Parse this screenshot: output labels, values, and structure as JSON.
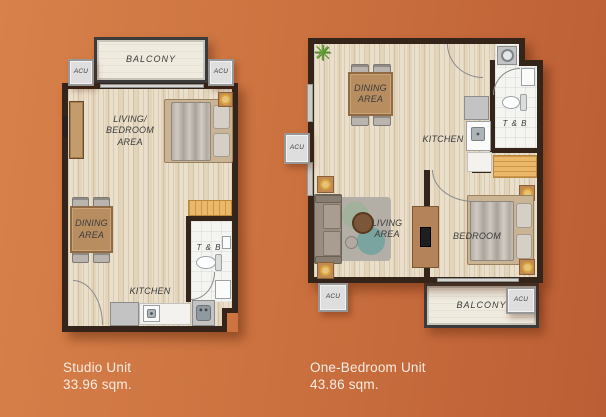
{
  "colors": {
    "bg_gradient_start": "#d8814a",
    "bg_gradient_end": "#bc5e35",
    "wall": "#35241a",
    "floor_wood": "#eadfca",
    "room_label": "#3b3b3b",
    "caption_text": "#f8ece3"
  },
  "icons": {
    "plant": "✳"
  },
  "labels": {
    "balcony": "BALCONY",
    "acu": "ACU",
    "tb": "T & B",
    "kitchen": "KITCHEN",
    "dining_area": "DINING\nAREA",
    "living_bedroom_area": "LIVING/\nBEDROOM\nAREA",
    "living_area": "LIVING\nAREA",
    "bedroom": "BEDROOM"
  },
  "units": [
    {
      "name": "Studio Unit",
      "area": "33.96 sqm."
    },
    {
      "name": "One-Bedroom Unit",
      "area": "43.86 sqm."
    }
  ]
}
